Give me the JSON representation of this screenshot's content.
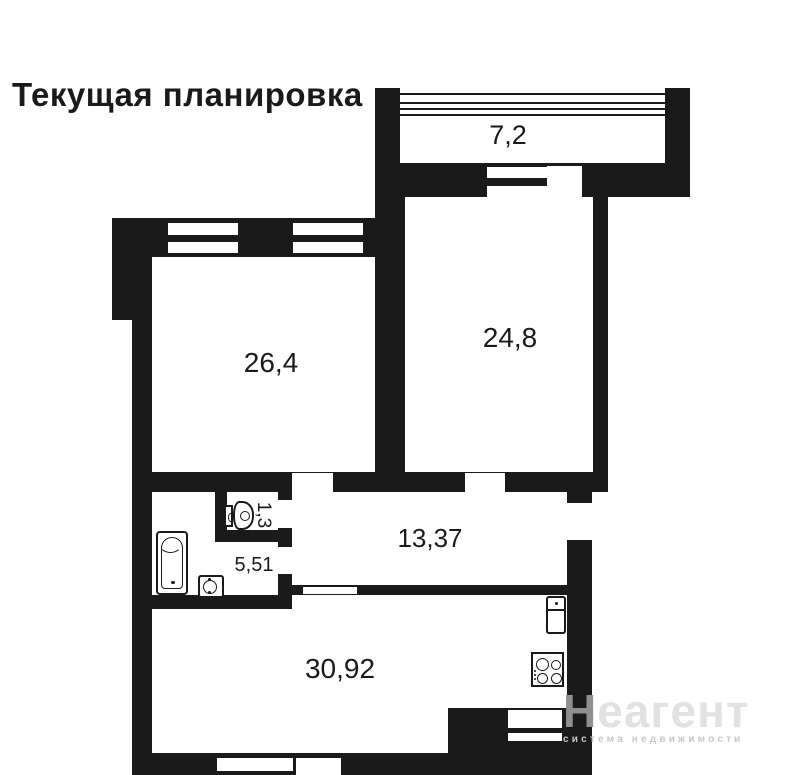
{
  "title": "Текущая планировка",
  "rooms": {
    "balcony": {
      "label": "7,2"
    },
    "living": {
      "label": "26,4"
    },
    "bedroom": {
      "label": "24,8"
    },
    "hallway": {
      "label": "13,37"
    },
    "wc": {
      "label": "1,3"
    },
    "bathroom": {
      "label": "5,51"
    },
    "kitchen_living": {
      "label": "30,92"
    }
  },
  "fixtures": [
    "bathtub-icon",
    "sink-icon",
    "toilet-icon",
    "fridge-icon",
    "stove-icon"
  ],
  "colors": {
    "wall": "#1a1a1a",
    "background": "#ffffff",
    "watermark_first_letter": "#8f8f8f",
    "watermark_text": "#e2e2e2",
    "watermark_tagline": "#c7c7c7"
  },
  "watermark": {
    "first_letter": "Н",
    "rest": "еагент",
    "tagline": "система недвижимости"
  }
}
